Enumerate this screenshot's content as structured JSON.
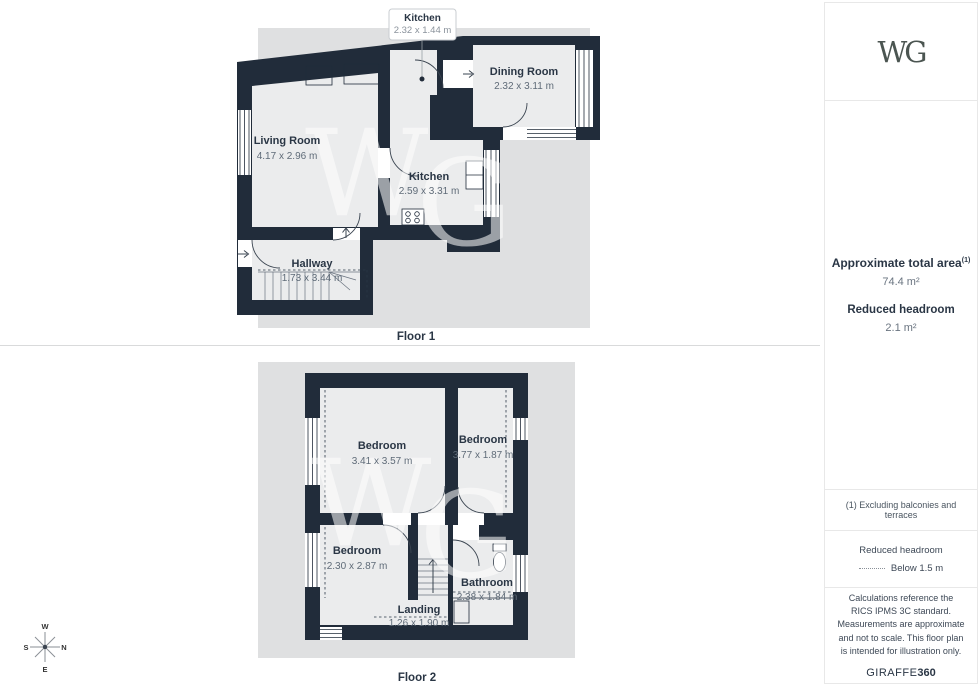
{
  "colors": {
    "wall": "#212c3a",
    "backdrop": "#dfe0e1",
    "floor": "#ebeced",
    "room_label": "#2a3645",
    "room_dims": "#5f6b78",
    "logo": "#4b5551",
    "watermark": "#ffffff"
  },
  "watermark": {
    "w": "W",
    "g": "G"
  },
  "floor1": {
    "label": "Floor 1",
    "callout": {
      "room": "Kitchen",
      "dims": "2.32 x 1.44 m"
    },
    "rooms": {
      "living": {
        "name": "Living Room",
        "dims": "4.17 x 2.96 m"
      },
      "kitchen": {
        "name": "Kitchen",
        "dims": "2.59 x 3.31 m"
      },
      "dining": {
        "name": "Dining Room",
        "dims": "2.32 x 3.11 m"
      },
      "hallway": {
        "name": "Hallway",
        "dims": "1.73 x 3.44 m"
      }
    }
  },
  "floor2": {
    "label": "Floor 2",
    "rooms": {
      "bedroom1": {
        "name": "Bedroom",
        "dims": "3.41 x 3.57 m"
      },
      "bedroom2": {
        "name": "Bedroom",
        "dims": "3.77 x 1.87 m"
      },
      "bedroom3": {
        "name": "Bedroom",
        "dims": "2.30 x 2.87 m"
      },
      "bathroom": {
        "name": "Bathroom",
        "dims": "2.38 x 1.84 m"
      },
      "landing": {
        "name": "Landing",
        "dims": "1.26 x 1.90 m"
      }
    }
  },
  "sidebar": {
    "logo": "WG",
    "total_area_label": "Approximate total area",
    "total_area_superscript": "(1)",
    "total_area_value": "74.4 m²",
    "reduced_headroom_label": "Reduced headroom",
    "reduced_headroom_value": "2.1 m²",
    "footnote": "(1) Excluding balconies and terraces",
    "legend_title": "Reduced headroom",
    "legend_value": "Below 1.5 m",
    "disclaimer": "Calculations reference the RICS IPMS 3C standard. Measurements are approximate and not to scale. This floor plan is intended for illustration only.",
    "brand": "GIRAFFE",
    "brand_suffix": "360"
  },
  "compass": {
    "n": "N",
    "e": "E",
    "s": "S",
    "w": "W"
  }
}
